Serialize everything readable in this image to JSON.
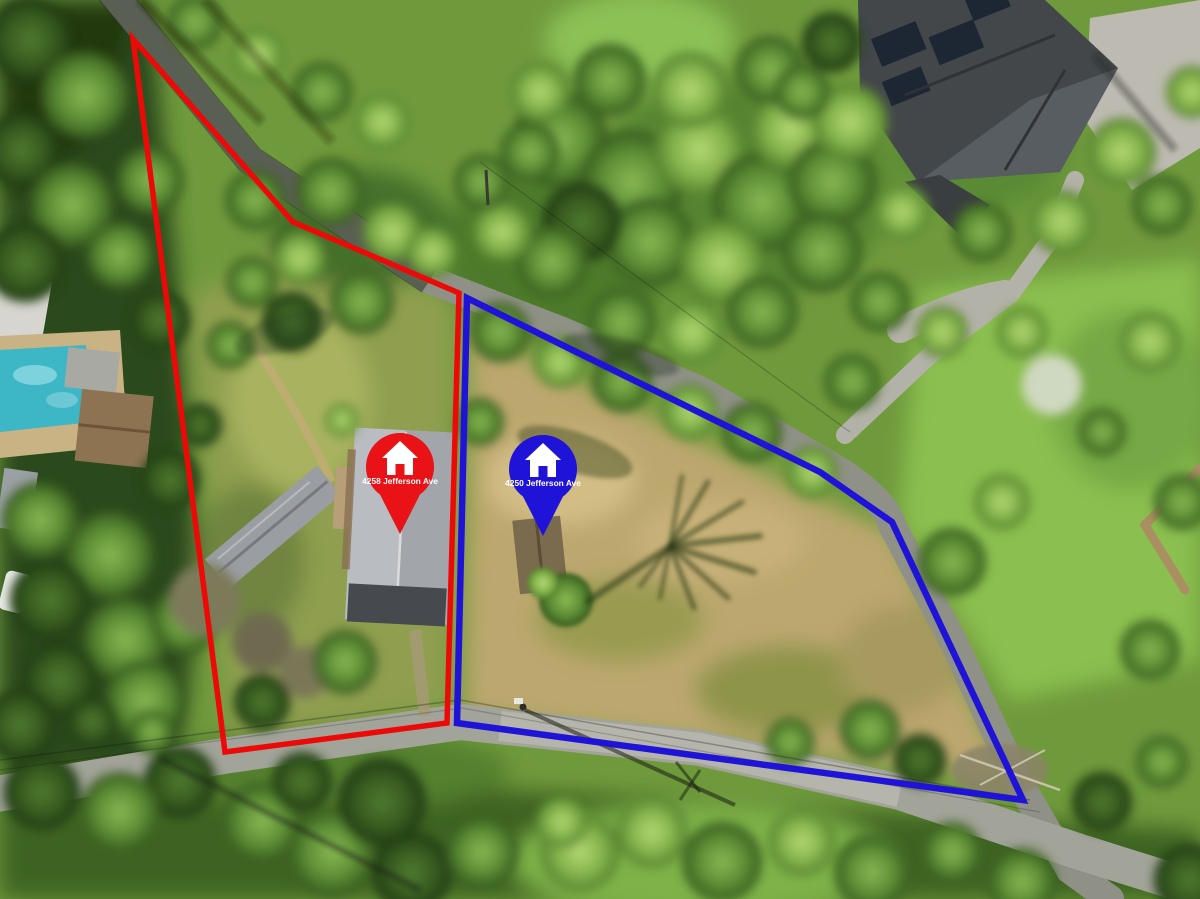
{
  "photo": {
    "kind": "aerial-drone-photo",
    "width": 1200,
    "height": 899
  },
  "lots": {
    "red": {
      "name": "4258 Jefferson Ave lot boundary",
      "color": "#ec0a08",
      "points": "133,39 293,222 459,293 447,723 225,752"
    },
    "blue": {
      "name": "4250 Jefferson Ave lot boundary",
      "color": "#2013d8",
      "points": "467,298 820,472 892,522 1023,800 457,723"
    }
  },
  "pins": {
    "red": {
      "label": "4258 Jefferson Ave",
      "color": "#e81217",
      "text_color": "#ffffff",
      "transform": "translate(400,534)",
      "icon": "house-icon"
    },
    "blue": {
      "label": "4250 Jefferson Ave",
      "color": "#2013d8",
      "text_color": "#ffffff",
      "transform": "translate(543,536)",
      "icon": "house-icon"
    }
  }
}
